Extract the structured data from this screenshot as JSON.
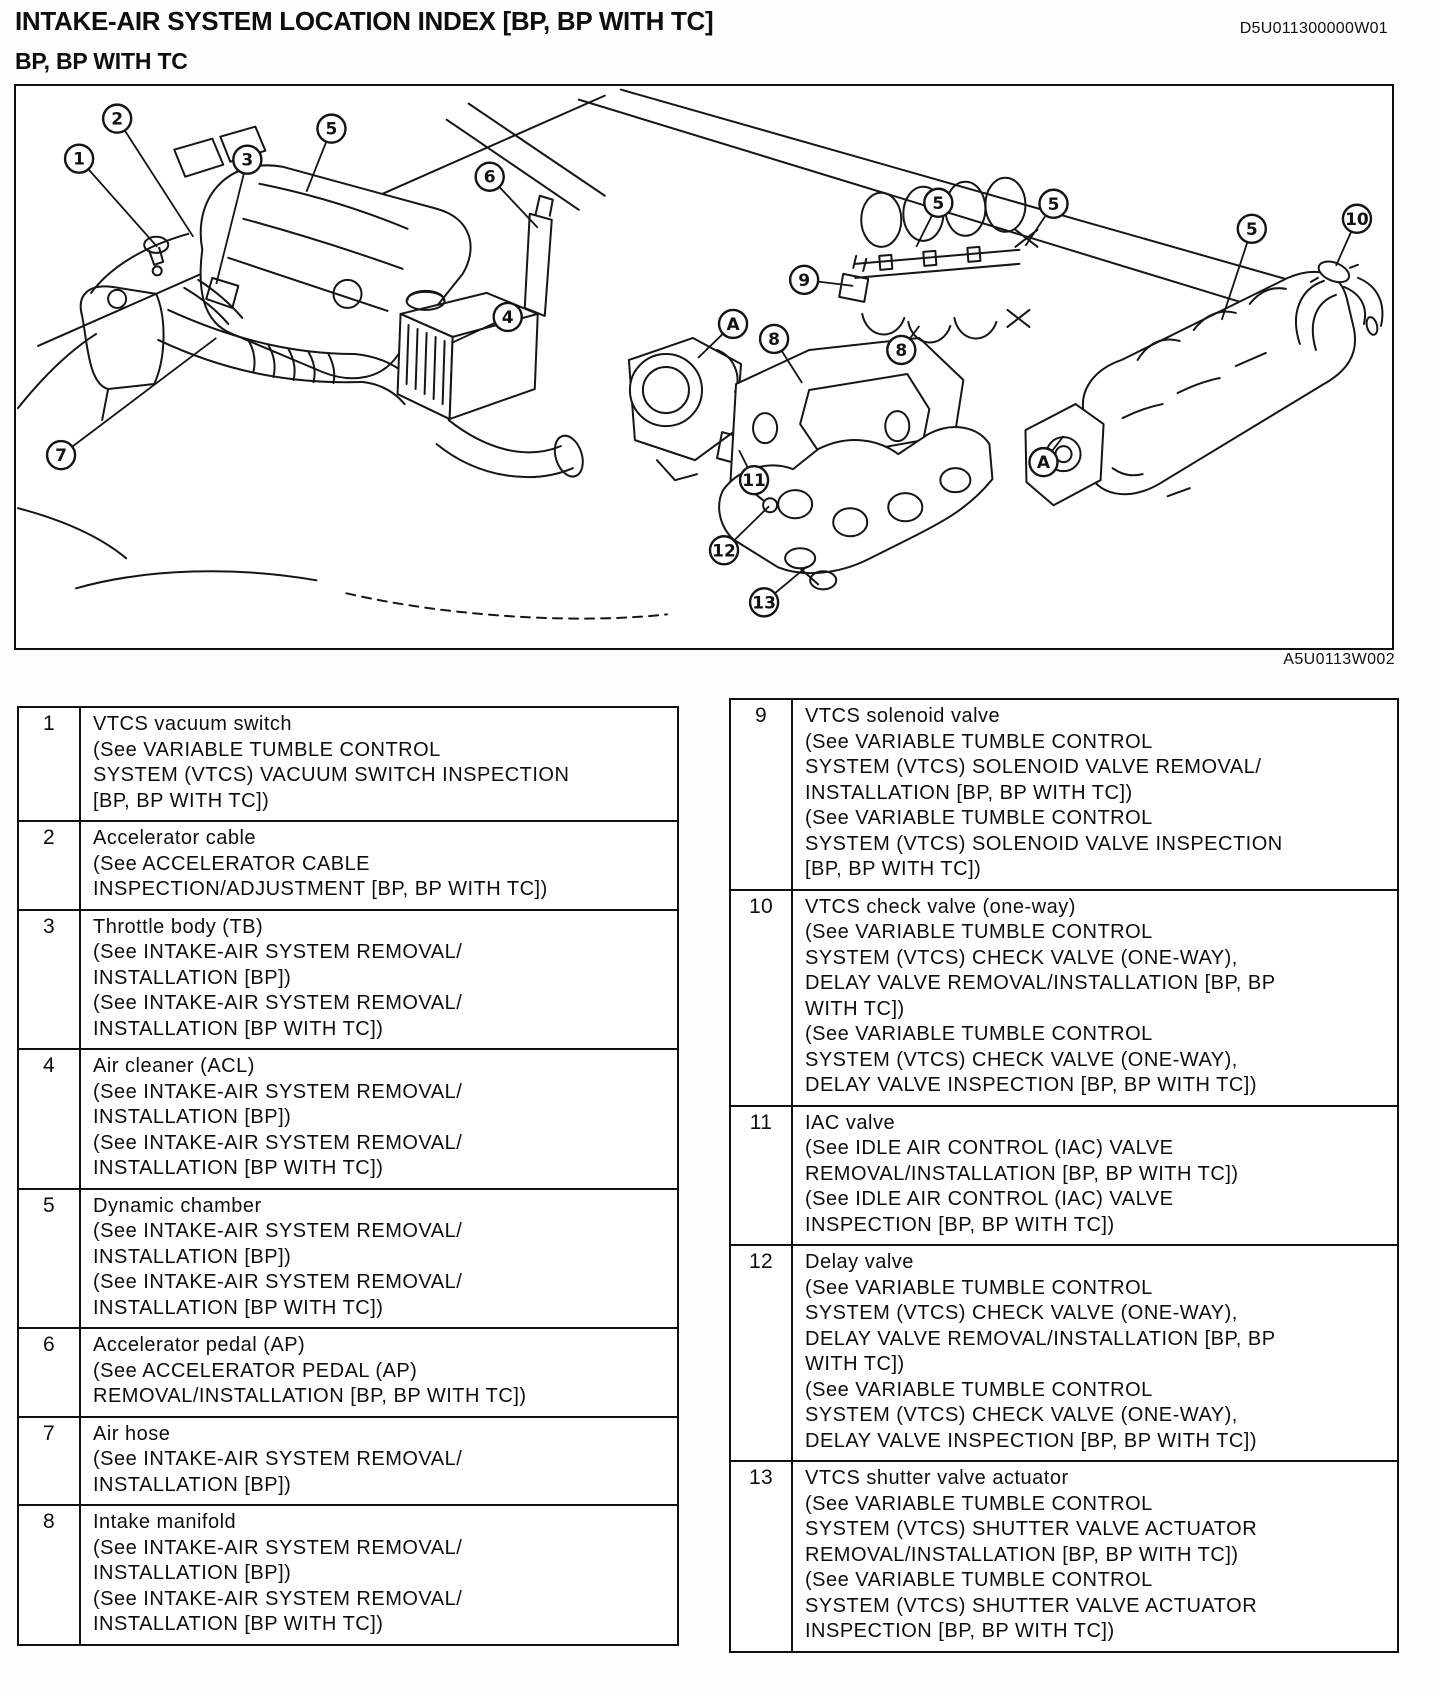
{
  "page": {
    "title": "INTAKE-AIR SYSTEM LOCATION INDEX [BP, BP WITH TC]",
    "doc_code": "D5U011300000W01",
    "subtitle": "BP, BP WITH TC"
  },
  "diagram": {
    "figure_code": "A5U0113W002",
    "callouts": [
      {
        "id": "callout-1",
        "label": "1",
        "x": 63,
        "y": 71,
        "tx": 141,
        "ty": 159
      },
      {
        "id": "callout-2",
        "label": "2",
        "x": 101,
        "y": 31,
        "tx": 177,
        "ty": 149
      },
      {
        "id": "callout-3",
        "label": "3",
        "x": 231,
        "y": 72,
        "tx": 200,
        "ty": 196
      },
      {
        "id": "callout-5a",
        "label": "5",
        "x": 315,
        "y": 41,
        "tx": 290,
        "ty": 104
      },
      {
        "id": "callout-6",
        "label": "6",
        "x": 473,
        "y": 89,
        "tx": 521,
        "ty": 140
      },
      {
        "id": "callout-4",
        "label": "4",
        "x": 491,
        "y": 229,
        "tx": 435,
        "ty": 255
      },
      {
        "id": "callout-7",
        "label": "7",
        "x": 45,
        "y": 367,
        "tx": 200,
        "ty": 250
      },
      {
        "id": "callout-A1",
        "label": "A",
        "x": 716,
        "y": 236,
        "tx": 681,
        "ty": 270
      },
      {
        "id": "callout-8a",
        "label": "8",
        "x": 757,
        "y": 251,
        "tx": 785,
        "ty": 295
      },
      {
        "id": "callout-9",
        "label": "9",
        "x": 787,
        "y": 192,
        "tx": 836,
        "ty": 198
      },
      {
        "id": "callout-5b",
        "label": "5",
        "x": 921,
        "y": 115,
        "tx": 899,
        "ty": 159
      },
      {
        "id": "callout-8b",
        "label": "8",
        "x": 884,
        "y": 262,
        "tx": 902,
        "ty": 238
      },
      {
        "id": "callout-5c",
        "label": "5",
        "x": 1036,
        "y": 116,
        "tx": 1008,
        "ty": 158
      },
      {
        "id": "callout-5d",
        "label": "5",
        "x": 1234,
        "y": 141,
        "tx": 1204,
        "ty": 232
      },
      {
        "id": "callout-10",
        "label": "10",
        "x": 1339,
        "y": 131,
        "tx": 1318,
        "ty": 178
      },
      {
        "id": "callout-11",
        "label": "11",
        "x": 737,
        "y": 392,
        "tx": 722,
        "ty": 362
      },
      {
        "id": "callout-12",
        "label": "12",
        "x": 707,
        "y": 462,
        "tx": 752,
        "ty": 418
      },
      {
        "id": "callout-13",
        "label": "13",
        "x": 747,
        "y": 514,
        "tx": 790,
        "ty": 478
      },
      {
        "id": "callout-A2",
        "label": "A",
        "x": 1026,
        "y": 374,
        "tx": 1046,
        "ty": 348
      }
    ]
  },
  "tables": {
    "left": [
      {
        "num": "1",
        "lines": [
          "VTCS vacuum switch",
          "(See VARIABLE TUMBLE CONTROL",
          "SYSTEM (VTCS) VACUUM SWITCH INSPECTION",
          "[BP, BP WITH TC])"
        ]
      },
      {
        "num": "2",
        "lines": [
          "Accelerator cable",
          "(See ACCELERATOR CABLE",
          "INSPECTION/ADJUSTMENT [BP, BP WITH TC])"
        ]
      },
      {
        "num": "3",
        "lines": [
          "Throttle body (TB)",
          "(See INTAKE-AIR SYSTEM REMOVAL/",
          "INSTALLATION [BP])",
          "(See INTAKE-AIR SYSTEM REMOVAL/",
          "INSTALLATION [BP WITH TC])"
        ]
      },
      {
        "num": "4",
        "lines": [
          "Air cleaner (ACL)",
          "(See INTAKE-AIR SYSTEM REMOVAL/",
          "INSTALLATION [BP])",
          "(See INTAKE-AIR SYSTEM REMOVAL/",
          "INSTALLATION [BP WITH TC])"
        ]
      },
      {
        "num": "5",
        "lines": [
          "Dynamic chamber",
          "(See INTAKE-AIR SYSTEM REMOVAL/",
          "INSTALLATION [BP])",
          "(See INTAKE-AIR SYSTEM REMOVAL/",
          "INSTALLATION [BP WITH TC])"
        ]
      },
      {
        "num": "6",
        "lines": [
          "Accelerator pedal (AP)",
          "(See ACCELERATOR PEDAL (AP)",
          "REMOVAL/INSTALLATION [BP, BP WITH TC])"
        ]
      },
      {
        "num": "7",
        "lines": [
          "Air hose",
          "(See INTAKE-AIR SYSTEM REMOVAL/",
          "INSTALLATION [BP])"
        ]
      },
      {
        "num": "8",
        "lines": [
          "Intake manifold",
          "(See INTAKE-AIR SYSTEM REMOVAL/",
          "INSTALLATION [BP])",
          "(See INTAKE-AIR SYSTEM REMOVAL/",
          "INSTALLATION [BP WITH TC])"
        ]
      }
    ],
    "right": [
      {
        "num": "9",
        "lines": [
          "VTCS solenoid valve",
          "(See VARIABLE TUMBLE CONTROL",
          "SYSTEM (VTCS) SOLENOID VALVE REMOVAL/",
          "INSTALLATION [BP, BP WITH TC])",
          "(See VARIABLE TUMBLE CONTROL",
          "SYSTEM (VTCS) SOLENOID VALVE INSPECTION",
          "[BP, BP WITH TC])"
        ]
      },
      {
        "num": "10",
        "lines": [
          "VTCS check valve (one-way)",
          "(See VARIABLE TUMBLE CONTROL",
          "SYSTEM (VTCS) CHECK VALVE (ONE-WAY),",
          "DELAY VALVE REMOVAL/INSTALLATION [BP, BP",
          "WITH TC])",
          "(See VARIABLE TUMBLE CONTROL",
          "SYSTEM (VTCS) CHECK VALVE (ONE-WAY),",
          "DELAY VALVE INSPECTION [BP, BP WITH TC])"
        ]
      },
      {
        "num": "11",
        "lines": [
          "IAC valve",
          "(See IDLE AIR CONTROL (IAC) VALVE",
          "REMOVAL/INSTALLATION [BP, BP WITH TC])",
          "(See IDLE AIR CONTROL (IAC) VALVE",
          "INSPECTION [BP, BP WITH TC])"
        ]
      },
      {
        "num": "12",
        "lines": [
          "Delay valve",
          "(See VARIABLE TUMBLE CONTROL",
          "SYSTEM (VTCS) CHECK VALVE (ONE-WAY),",
          "DELAY VALVE REMOVAL/INSTALLATION [BP, BP",
          "WITH TC])",
          "(See VARIABLE TUMBLE CONTROL",
          "SYSTEM (VTCS) CHECK VALVE (ONE-WAY),",
          "DELAY VALVE INSPECTION [BP, BP WITH TC])"
        ]
      },
      {
        "num": "13",
        "lines": [
          "VTCS shutter valve actuator",
          "(See VARIABLE TUMBLE CONTROL",
          "SYSTEM (VTCS) SHUTTER VALVE ACTUATOR",
          "REMOVAL/INSTALLATION [BP, BP WITH TC])",
          "(See VARIABLE TUMBLE CONTROL",
          "SYSTEM (VTCS) SHUTTER VALVE ACTUATOR",
          "INSPECTION [BP, BP WITH TC])"
        ]
      }
    ]
  }
}
